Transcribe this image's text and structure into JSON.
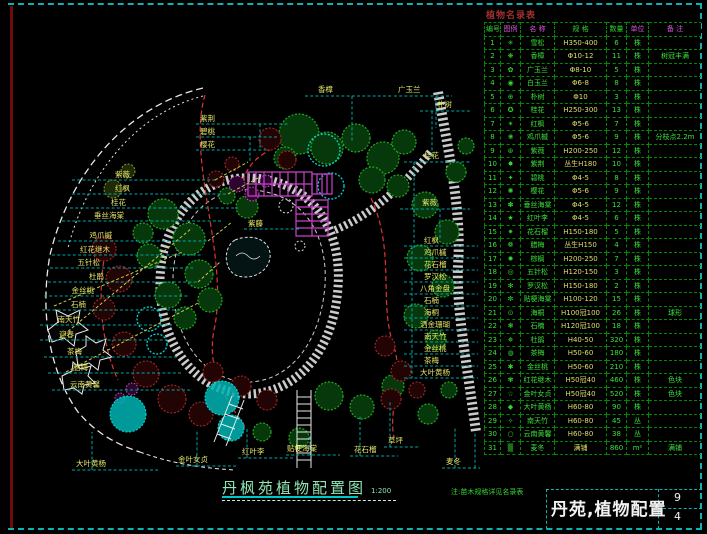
{
  "colors": {
    "frame_teal": "#0fb2b2",
    "frame_maroon": "#6e0b0b",
    "label_yellow": "#e6e668",
    "leader_cyan": "#00a6a6",
    "tree_green": "#1fae1f",
    "shrub_red": "#a22b2b",
    "pergola_magenta": "#cc3fcc",
    "water_cyan": "#00d8d8",
    "table_green": "#3ae03a",
    "spec_yellow": "#dede6e",
    "header_magenta": "#d955d9",
    "title_green": "#8ee6b4",
    "schedule_title_red": "#a03030",
    "titleblock_white": "#f2f2f2"
  },
  "plan": {
    "labels": [
      {
        "t": "紫薇",
        "x": 130,
        "y": 177,
        "a": "e",
        "cs": [
          [
            72,
            180,
            215,
            180
          ]
        ],
        "ys": [
          [
            215,
            180,
            248,
            162
          ]
        ]
      },
      {
        "t": "红枫",
        "x": 130,
        "y": 191,
        "a": "e",
        "cs": [
          [
            72,
            194,
            228,
            194
          ]
        ],
        "ys": [
          [
            228,
            194,
            258,
            178
          ]
        ]
      },
      {
        "t": "桂花",
        "x": 126,
        "y": 205,
        "a": "e",
        "cs": [
          [
            70,
            208,
            238,
            208
          ]
        ]
      },
      {
        "t": "垂丝海棠",
        "x": 124,
        "y": 218,
        "a": "e",
        "cs": [
          [
            62,
            221,
            222,
            221
          ]
        ]
      },
      {
        "t": "鸡爪槭",
        "x": 112,
        "y": 238,
        "a": "e",
        "cs": [
          [
            58,
            241,
            208,
            241
          ]
        ],
        "ys": [
          [
            208,
            241,
            232,
            222
          ]
        ]
      },
      {
        "t": "红花继木",
        "x": 110,
        "y": 252,
        "a": "e",
        "cs": [
          [
            52,
            255,
            203,
            255
          ]
        ]
      },
      {
        "t": "五针松",
        "x": 100,
        "y": 265,
        "a": "e",
        "c": "#5ad8d8",
        "cs": [
          [
            50,
            268,
            193,
            268
          ]
        ]
      },
      {
        "t": "杜鹃",
        "x": 104,
        "y": 279,
        "a": "e",
        "cs": [
          [
            48,
            282,
            198,
            282
          ]
        ],
        "ys": [
          [
            198,
            282,
            220,
            262
          ]
        ]
      },
      {
        "t": "金丝桃",
        "x": 94,
        "y": 293,
        "a": "e",
        "cs": [
          [
            44,
            296,
            188,
            296
          ]
        ]
      },
      {
        "t": "石楠",
        "x": 86,
        "y": 307,
        "a": "e",
        "cs": [
          [
            42,
            310,
            182,
            310
          ]
        ]
      },
      {
        "t": "南天竹",
        "x": 80,
        "y": 322,
        "a": "e",
        "cs": [
          [
            40,
            325,
            172,
            325
          ]
        ]
      },
      {
        "t": "迎春",
        "x": 74,
        "y": 337,
        "a": "e",
        "cs": [
          [
            40,
            340,
            168,
            340
          ]
        ]
      },
      {
        "t": "茶梅",
        "x": 82,
        "y": 354,
        "a": "e",
        "cs": [
          [
            44,
            357,
            178,
            357
          ]
        ]
      },
      {
        "t": "腊梅",
        "x": 88,
        "y": 370,
        "a": "e",
        "cs": [
          [
            48,
            373,
            183,
            373
          ]
        ]
      },
      {
        "t": "云南黄馨",
        "x": 100,
        "y": 387,
        "a": "e",
        "cs": [
          [
            52,
            390,
            192,
            390
          ]
        ]
      },
      {
        "t": "紫荆",
        "x": 200,
        "y": 121,
        "cs": [
          [
            196,
            124,
            288,
            124
          ],
          [
            260,
            124,
            260,
            150
          ]
        ]
      },
      {
        "t": "碧桃",
        "x": 200,
        "y": 134,
        "cs": [
          [
            196,
            137,
            278,
            137
          ],
          [
            250,
            137,
            250,
            162
          ]
        ]
      },
      {
        "t": "樱花",
        "x": 200,
        "y": 147,
        "cs": [
          [
            196,
            150,
            268,
            150
          ]
        ]
      },
      {
        "t": "香樟",
        "x": 318,
        "y": 92,
        "cs": [
          [
            305,
            96,
            392,
            96
          ],
          [
            352,
            96,
            352,
            142
          ]
        ]
      },
      {
        "t": "广玉兰",
        "x": 398,
        "y": 92,
        "cs": [
          [
            394,
            96,
            452,
            96
          ],
          [
            436,
            96,
            436,
            128
          ]
        ]
      },
      {
        "t": "朴树",
        "x": 437,
        "y": 107,
        "cs": [
          [
            420,
            111,
            470,
            111
          ],
          [
            432,
            111,
            432,
            158
          ]
        ]
      },
      {
        "t": "桂花",
        "x": 424,
        "y": 158,
        "cs": [
          [
            404,
            162,
            470,
            162
          ],
          [
            414,
            162,
            414,
            248
          ]
        ]
      },
      {
        "t": "紫薇",
        "x": 422,
        "y": 205,
        "cs": [
          [
            400,
            209,
            470,
            209
          ],
          [
            440,
            209,
            440,
            238
          ]
        ]
      },
      {
        "t": "红枫",
        "x": 424,
        "y": 243,
        "cs": [
          [
            404,
            246,
            478,
            246
          ]
        ]
      },
      {
        "t": "鸡爪槭",
        "x": 424,
        "y": 255,
        "cs": [
          [
            404,
            258,
            478,
            258
          ]
        ]
      },
      {
        "t": "花石榴",
        "x": 424,
        "y": 267,
        "cs": [
          [
            404,
            270,
            478,
            270
          ]
        ]
      },
      {
        "t": "罗汉松",
        "x": 424,
        "y": 279,
        "cs": [
          [
            404,
            282,
            478,
            282
          ]
        ]
      },
      {
        "t": "八角金盘",
        "x": 420,
        "y": 291,
        "cs": [
          [
            404,
            294,
            478,
            294
          ]
        ]
      },
      {
        "t": "石楠",
        "x": 424,
        "y": 303,
        "cs": [
          [
            404,
            306,
            478,
            306
          ]
        ]
      },
      {
        "t": "海桐",
        "x": 424,
        "y": 315,
        "cs": [
          [
            404,
            318,
            478,
            318
          ]
        ]
      },
      {
        "t": "洒金珊瑚",
        "x": 420,
        "y": 327,
        "cs": [
          [
            404,
            330,
            478,
            330
          ]
        ]
      },
      {
        "t": "南天竹",
        "x": 424,
        "y": 339,
        "cs": [
          [
            404,
            342,
            478,
            342
          ]
        ]
      },
      {
        "t": "金丝桃",
        "x": 424,
        "y": 351,
        "cs": [
          [
            404,
            354,
            478,
            354
          ]
        ]
      },
      {
        "t": "茶梅",
        "x": 424,
        "y": 363,
        "cs": [
          [
            404,
            366,
            478,
            366
          ]
        ]
      },
      {
        "t": "大叶黄杨",
        "x": 420,
        "y": 375,
        "cs": [
          [
            404,
            378,
            478,
            378
          ],
          [
            412,
            246,
            412,
            378
          ]
        ]
      },
      {
        "t": "紫藤",
        "x": 248,
        "y": 226,
        "cs": [
          [
            244,
            229,
            300,
            229
          ]
        ]
      },
      {
        "t": "大叶黄杨",
        "x": 76,
        "y": 466,
        "cs": [
          [
            72,
            470,
            158,
            470
          ],
          [
            92,
            470,
            92,
            432
          ]
        ]
      },
      {
        "t": "金叶女贞",
        "x": 178,
        "y": 462,
        "cs": [
          [
            176,
            466,
            236,
            466
          ],
          [
            197,
            466,
            197,
            430
          ]
        ]
      },
      {
        "t": "红叶李",
        "x": 242,
        "y": 454,
        "cs": [
          [
            238,
            458,
            294,
            458
          ],
          [
            247,
            458,
            247,
            428
          ]
        ]
      },
      {
        "t": "贴梗海棠",
        "x": 287,
        "y": 451,
        "cs": [
          [
            286,
            455,
            340,
            455
          ],
          [
            310,
            455,
            310,
            436
          ]
        ]
      },
      {
        "t": "花石榴",
        "x": 354,
        "y": 452,
        "cs": [
          [
            350,
            456,
            398,
            456
          ],
          [
            360,
            456,
            360,
            416
          ]
        ]
      },
      {
        "t": "草坪",
        "x": 388,
        "y": 443,
        "cs": [
          [
            384,
            447,
            420,
            447
          ],
          [
            390,
            447,
            390,
            402
          ]
        ]
      },
      {
        "t": "麦冬",
        "x": 446,
        "y": 464,
        "cs": [
          [
            442,
            468,
            480,
            468
          ],
          [
            455,
            468,
            455,
            428
          ],
          [
            475,
            468,
            475,
            432
          ]
        ]
      }
    ],
    "fans": [
      [
        60,
        338,
        192,
        228
      ],
      [
        54,
        306,
        182,
        252
      ],
      [
        66,
        372,
        200,
        302
      ]
    ],
    "clusters": {
      "green": [
        [
          299,
          134,
          20
        ],
        [
          327,
          148,
          16
        ],
        [
          356,
          138,
          14
        ],
        [
          383,
          158,
          16
        ],
        [
          404,
          142,
          12
        ],
        [
          285,
          158,
          11
        ],
        [
          372,
          180,
          13
        ],
        [
          398,
          186,
          11
        ],
        [
          425,
          205,
          13
        ],
        [
          447,
          232,
          12
        ],
        [
          420,
          258,
          13
        ],
        [
          443,
          286,
          11
        ],
        [
          416,
          316,
          12
        ],
        [
          436,
          340,
          10
        ],
        [
          456,
          172,
          10
        ],
        [
          466,
          146,
          8
        ],
        [
          163,
          214,
          15
        ],
        [
          189,
          239,
          16
        ],
        [
          149,
          256,
          12
        ],
        [
          199,
          274,
          14
        ],
        [
          168,
          295,
          13
        ],
        [
          143,
          233,
          10
        ],
        [
          210,
          300,
          12
        ],
        [
          185,
          318,
          11
        ],
        [
          247,
          207,
          11
        ],
        [
          227,
          196,
          8
        ],
        [
          329,
          396,
          14
        ],
        [
          362,
          407,
          12
        ],
        [
          393,
          386,
          11
        ],
        [
          428,
          414,
          10
        ],
        [
          299,
          438,
          10
        ],
        [
          262,
          432,
          9
        ],
        [
          449,
          390,
          8
        ]
      ],
      "olive": [
        [
          113,
          189,
          9
        ],
        [
          128,
          171,
          7
        ]
      ],
      "red": [
        [
          104,
          249,
          12
        ],
        [
          119,
          279,
          13
        ],
        [
          104,
          309,
          11
        ],
        [
          124,
          344,
          12
        ],
        [
          146,
          374,
          13
        ],
        [
          172,
          399,
          14
        ],
        [
          201,
          414,
          12
        ],
        [
          270,
          139,
          11
        ],
        [
          287,
          160,
          9
        ],
        [
          213,
          372,
          10
        ],
        [
          241,
          386,
          10
        ],
        [
          267,
          400,
          10
        ],
        [
          385,
          346,
          10
        ],
        [
          401,
          371,
          10
        ],
        [
          391,
          399,
          10
        ],
        [
          417,
          390,
          8
        ],
        [
          216,
          179,
          8
        ],
        [
          232,
          164,
          7
        ]
      ],
      "magenta": [
        [
          237,
          184,
          8
        ],
        [
          252,
          194,
          7
        ],
        [
          266,
          181,
          6
        ],
        [
          132,
          389,
          6
        ],
        [
          120,
          398,
          5
        ]
      ],
      "cyan_outline": [
        [
          324,
          150,
          16
        ],
        [
          331,
          186,
          13
        ],
        [
          149,
          319,
          12
        ],
        [
          157,
          344,
          10
        ]
      ],
      "cyan_fill": [
        [
          128,
          414,
          18
        ],
        [
          222,
          398,
          17
        ],
        [
          231,
          428,
          13
        ]
      ]
    }
  },
  "schedule": {
    "title": "植物名录表",
    "headers": [
      "编号",
      "图例",
      "名 称",
      "规 格",
      "数量",
      "单位",
      "备 注"
    ],
    "rows": [
      [
        "1",
        "✳",
        "雪松",
        "H350-400",
        "6",
        "株",
        ""
      ],
      [
        "2",
        "❋",
        "香樟",
        "Φ10-12",
        "11",
        "株",
        "树冠丰满"
      ],
      [
        "3",
        "✿",
        "广玉兰",
        "Φ8-10",
        "5",
        "株",
        ""
      ],
      [
        "4",
        "◉",
        "白玉兰",
        "Φ6-8",
        "8",
        "株",
        ""
      ],
      [
        "5",
        "⊕",
        "朴树",
        "Φ10",
        "3",
        "株",
        ""
      ],
      [
        "6",
        "✪",
        "桂花",
        "H250-300",
        "13",
        "株",
        ""
      ],
      [
        "7",
        "✶",
        "红枫",
        "Φ5-6",
        "7",
        "株",
        ""
      ],
      [
        "8",
        "❀",
        "鸡爪槭",
        "Φ5-6",
        "9",
        "株",
        "分枝点2.2m"
      ],
      [
        "9",
        "⊛",
        "紫薇",
        "H200-250",
        "12",
        "株",
        ""
      ],
      [
        "10",
        "✸",
        "紫荆",
        "丛生H180",
        "10",
        "株",
        ""
      ],
      [
        "11",
        "✦",
        "碧桃",
        "Φ4-5",
        "8",
        "株",
        ""
      ],
      [
        "12",
        "✺",
        "樱花",
        "Φ5-6",
        "9",
        "株",
        ""
      ],
      [
        "13",
        "✽",
        "垂丝海棠",
        "Φ4-5",
        "12",
        "株",
        ""
      ],
      [
        "14",
        "★",
        "红叶李",
        "Φ4-5",
        "6",
        "株",
        ""
      ],
      [
        "15",
        "✷",
        "花石榴",
        "H150-180",
        "5",
        "株",
        ""
      ],
      [
        "16",
        "❁",
        "腊梅",
        "丛生H150",
        "4",
        "株",
        ""
      ],
      [
        "17",
        "✹",
        "棕榈",
        "H200-250",
        "7",
        "株",
        ""
      ],
      [
        "18",
        "◎",
        "五针松",
        "H120-150",
        "3",
        "株",
        ""
      ],
      [
        "19",
        "✻",
        "罗汉松",
        "H150-180",
        "2",
        "株",
        ""
      ],
      [
        "20",
        "✼",
        "贴梗海棠",
        "H100-120",
        "15",
        "株",
        ""
      ],
      [
        "21",
        "⊙",
        "海桐",
        "H100冠100",
        "26",
        "株",
        "球形"
      ],
      [
        "22",
        "❃",
        "石楠",
        "H120冠100",
        "18",
        "株",
        ""
      ],
      [
        "23",
        "✵",
        "杜鹃",
        "H40-50",
        "320",
        "株",
        ""
      ],
      [
        "24",
        "◍",
        "茶梅",
        "H50-60",
        "180",
        "株",
        ""
      ],
      [
        "25",
        "✱",
        "金丝桃",
        "H50-60",
        "210",
        "株",
        ""
      ],
      [
        "26",
        "✾",
        "红花继木",
        "H50冠40",
        "460",
        "株",
        "色块"
      ],
      [
        "27",
        "☆",
        "金叶女贞",
        "H50冠40",
        "520",
        "株",
        "色块"
      ],
      [
        "28",
        "◆",
        "大叶黄杨",
        "H60-80",
        "90",
        "株",
        ""
      ],
      [
        "29",
        "✧",
        "南天竹",
        "H60-80",
        "45",
        "丛",
        ""
      ],
      [
        "30",
        "○",
        "云南黄馨",
        "H60-80",
        "38",
        "丛",
        ""
      ],
      [
        "31",
        "▒",
        "麦冬",
        "满铺",
        "860",
        "m²",
        "满铺"
      ]
    ]
  },
  "footer": {
    "drawing_title": "丹枫苑植物配置图",
    "scale": "1:200",
    "note": "注:苗木规格详见名录表",
    "titleblock": {
      "name": "丹苑,植物配置",
      "sheet_top": "9",
      "sheet_bottom": "4"
    }
  }
}
